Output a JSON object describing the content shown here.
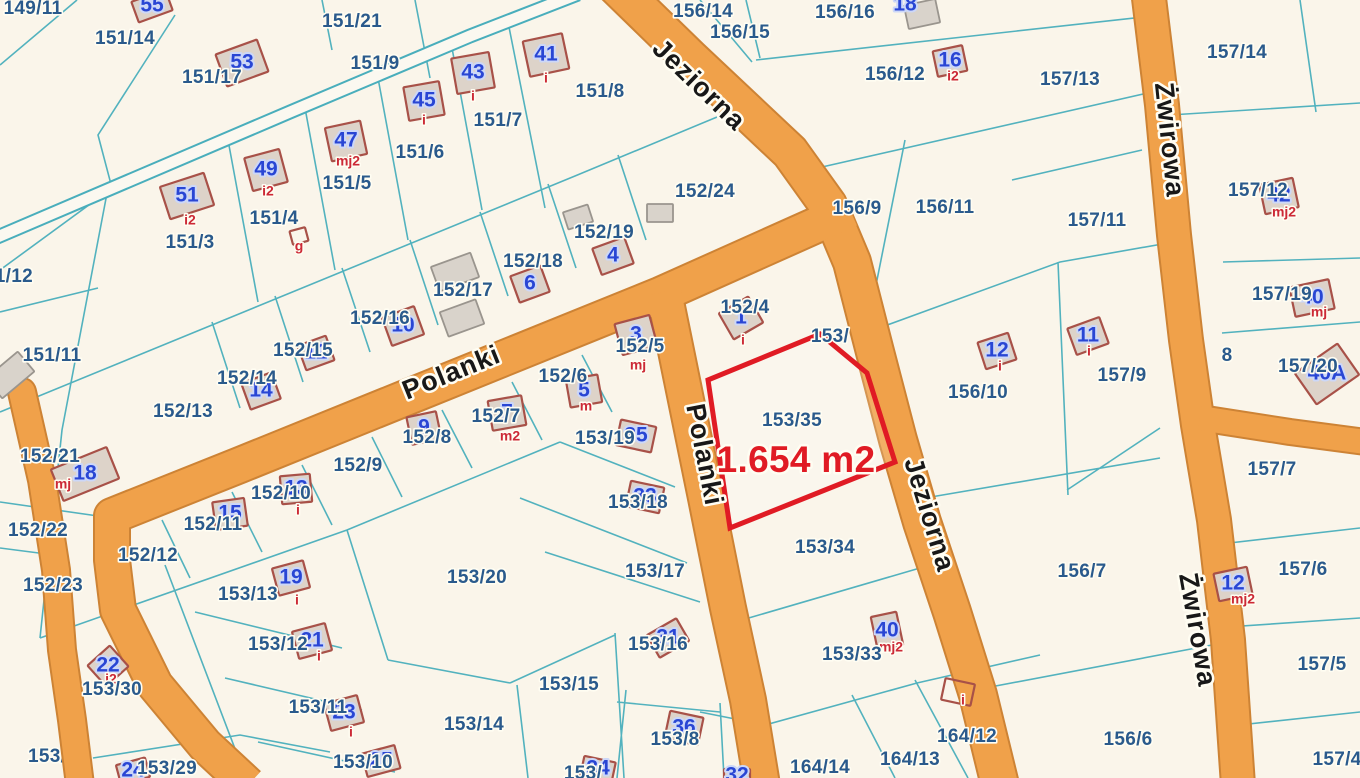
{
  "map": {
    "highlight": {
      "parcel": "153/35",
      "area_label": "1.654 m2"
    },
    "colors": {
      "background": "#faf5ea",
      "road": "#f0a14a",
      "road_casing": "#cd8335",
      "boundary": "#49aebc",
      "parcel_text": "#2a5a8c",
      "building_number": "#2946d4",
      "building_fill": "#ddd3c9",
      "building_outline": "#a85148",
      "sub_label": "#cc2936",
      "highlight_red": "#e01b24",
      "path_fill": "#fbf8f0"
    },
    "streets": [
      {
        "name": "Jeziorna",
        "x": 698,
        "y": 86,
        "rot": 44
      },
      {
        "name": "Jeziorna",
        "x": 928,
        "y": 515,
        "rot": 73
      },
      {
        "name": "Polanki",
        "x": 452,
        "y": 374,
        "rot": -22
      },
      {
        "name": "Polanki",
        "x": 703,
        "y": 455,
        "rot": 79
      },
      {
        "name": "Żwirowa",
        "x": 1168,
        "y": 140,
        "rot": 84
      },
      {
        "name": "Żwirowa",
        "x": 1196,
        "y": 630,
        "rot": 80
      }
    ],
    "parcels": [
      {
        "t": "149/11",
        "x": 33,
        "y": 9
      },
      {
        "t": "151/14",
        "x": 125,
        "y": 39
      },
      {
        "t": "151/17",
        "x": 212,
        "y": 78
      },
      {
        "t": "151/21",
        "x": 352,
        "y": 22
      },
      {
        "t": "151/9",
        "x": 375,
        "y": 64
      },
      {
        "t": "151/8",
        "x": 600,
        "y": 92
      },
      {
        "t": "151/7",
        "x": 498,
        "y": 121
      },
      {
        "t": "151/6",
        "x": 420,
        "y": 153
      },
      {
        "t": "151/5",
        "x": 347,
        "y": 184
      },
      {
        "t": "151/4",
        "x": 274,
        "y": 219
      },
      {
        "t": "151/3",
        "x": 190,
        "y": 243
      },
      {
        "t": "151/12",
        "x": 3,
        "y": 277
      },
      {
        "t": "151/11",
        "x": 52,
        "y": 356
      },
      {
        "t": "152/13",
        "x": 183,
        "y": 412
      },
      {
        "t": "152/14",
        "x": 247,
        "y": 379
      },
      {
        "t": "152/15",
        "x": 303,
        "y": 351
      },
      {
        "t": "152/16",
        "x": 380,
        "y": 319
      },
      {
        "t": "152/17",
        "x": 463,
        "y": 291
      },
      {
        "t": "152/18",
        "x": 533,
        "y": 262
      },
      {
        "t": "152/19",
        "x": 604,
        "y": 233
      },
      {
        "t": "152/24",
        "x": 705,
        "y": 192
      },
      {
        "t": "152/21",
        "x": 50,
        "y": 457
      },
      {
        "t": "152/22",
        "x": 38,
        "y": 531
      },
      {
        "t": "152/23",
        "x": 53,
        "y": 586
      },
      {
        "t": "152/12",
        "x": 148,
        "y": 556
      },
      {
        "t": "152/11",
        "x": 213,
        "y": 525
      },
      {
        "t": "152/10",
        "x": 281,
        "y": 494
      },
      {
        "t": "152/9",
        "x": 358,
        "y": 466
      },
      {
        "t": "152/8",
        "x": 427,
        "y": 438
      },
      {
        "t": "152/7",
        "x": 496,
        "y": 417
      },
      {
        "t": "152/6",
        "x": 563,
        "y": 377
      },
      {
        "t": "152/5",
        "x": 640,
        "y": 347
      },
      {
        "t": "152/4",
        "x": 745,
        "y": 308
      },
      {
        "t": "153/",
        "x": 830,
        "y": 337
      },
      {
        "t": "153/35",
        "x": 792,
        "y": 421
      },
      {
        "t": "1.654 m2",
        "x": 796,
        "y": 462,
        "cls": "area"
      },
      {
        "t": "153/34",
        "x": 825,
        "y": 548
      },
      {
        "t": "153/33",
        "x": 852,
        "y": 655
      },
      {
        "t": "153/19",
        "x": 605,
        "y": 439
      },
      {
        "t": "153/18",
        "x": 638,
        "y": 503
      },
      {
        "t": "153/17",
        "x": 655,
        "y": 572
      },
      {
        "t": "153/16",
        "x": 658,
        "y": 645
      },
      {
        "t": "153/20",
        "x": 477,
        "y": 578
      },
      {
        "t": "153/15",
        "x": 569,
        "y": 685
      },
      {
        "t": "153/14",
        "x": 474,
        "y": 725
      },
      {
        "t": "153/13",
        "x": 248,
        "y": 595
      },
      {
        "t": "153/12",
        "x": 278,
        "y": 645
      },
      {
        "t": "153/11",
        "x": 318,
        "y": 708
      },
      {
        "t": "153/10",
        "x": 363,
        "y": 763
      },
      {
        "t": "153/30",
        "x": 112,
        "y": 690
      },
      {
        "t": "153/29",
        "x": 167,
        "y": 769
      },
      {
        "t": "153/31",
        "x": 58,
        "y": 757,
        "under": true
      },
      {
        "t": "153/8",
        "x": 675,
        "y": 740
      },
      {
        "t": "153/",
        "x": 583,
        "y": 774
      },
      {
        "t": "164/14",
        "x": 820,
        "y": 768
      },
      {
        "t": "164/13",
        "x": 910,
        "y": 760
      },
      {
        "t": "164/12",
        "x": 967,
        "y": 737
      },
      {
        "t": "156/14",
        "x": 703,
        "y": 12
      },
      {
        "t": "156/15",
        "x": 740,
        "y": 33
      },
      {
        "t": "156/16",
        "x": 845,
        "y": 13
      },
      {
        "t": "156/12",
        "x": 895,
        "y": 75
      },
      {
        "t": "156/9",
        "x": 857,
        "y": 209
      },
      {
        "t": "156/11",
        "x": 945,
        "y": 208
      },
      {
        "t": "156/10",
        "x": 978,
        "y": 393
      },
      {
        "t": "156/7",
        "x": 1082,
        "y": 572
      },
      {
        "t": "156/6",
        "x": 1128,
        "y": 740
      },
      {
        "t": "157/13",
        "x": 1070,
        "y": 80
      },
      {
        "t": "157/14",
        "x": 1237,
        "y": 53
      },
      {
        "t": "157/11",
        "x": 1097,
        "y": 221
      },
      {
        "t": "157/12",
        "x": 1258,
        "y": 191
      },
      {
        "t": "157/9",
        "x": 1122,
        "y": 376
      },
      {
        "t": "157/19",
        "x": 1282,
        "y": 295
      },
      {
        "t": "157/20",
        "x": 1308,
        "y": 367
      },
      {
        "t": "8",
        "x": 1227,
        "y": 356
      },
      {
        "t": "157/7",
        "x": 1272,
        "y": 470
      },
      {
        "t": "157/6",
        "x": 1303,
        "y": 570
      },
      {
        "t": "157/5",
        "x": 1322,
        "y": 665
      },
      {
        "t": "157/4",
        "x": 1337,
        "y": 760
      }
    ],
    "buildings": [
      {
        "n": "55",
        "x": 152,
        "y": 6,
        "r": -20,
        "w": 36,
        "h": 22
      },
      {
        "n": "53",
        "x": 242,
        "y": 63,
        "r": -20,
        "w": 44,
        "h": 34
      },
      {
        "n": "41",
        "x": 546,
        "y": 55,
        "r": -12,
        "w": 40,
        "h": 36,
        "sub": "i",
        "sx": 546,
        "sy": 79
      },
      {
        "n": "43",
        "x": 473,
        "y": 73,
        "r": -10,
        "w": 38,
        "h": 36,
        "sub": "i",
        "sx": 473,
        "sy": 97
      },
      {
        "n": "45",
        "x": 424,
        "y": 101,
        "r": -10,
        "w": 36,
        "h": 34,
        "sub": "i",
        "sx": 424,
        "sy": 121
      },
      {
        "n": "47",
        "x": 346,
        "y": 141,
        "r": -12,
        "w": 36,
        "h": 34,
        "sub": "mj2",
        "sx": 348,
        "sy": 162
      },
      {
        "n": "49",
        "x": 266,
        "y": 170,
        "r": -15,
        "w": 36,
        "h": 34,
        "sub": "i2",
        "sx": 268,
        "sy": 192
      },
      {
        "n": "51",
        "x": 187,
        "y": 196,
        "r": -18,
        "w": 46,
        "h": 34,
        "sub": "i2",
        "sx": 190,
        "sy": 221
      },
      {
        "n": "",
        "x": 299,
        "y": 236,
        "r": -15,
        "w": 16,
        "h": 14,
        "hollow": true,
        "sub": "g",
        "sx": 299,
        "sy": 247
      },
      {
        "n": "4",
        "x": 613,
        "y": 256,
        "r": -20,
        "w": 34,
        "h": 28
      },
      {
        "n": "6",
        "x": 530,
        "y": 284,
        "r": -20,
        "w": 32,
        "h": 28
      },
      {
        "n": "10",
        "x": 403,
        "y": 326,
        "r": -20,
        "w": 34,
        "h": 30
      },
      {
        "n": "12",
        "x": 316,
        "y": 353,
        "r": -20,
        "w": 30,
        "h": 26
      },
      {
        "n": "14",
        "x": 261,
        "y": 391,
        "r": -20,
        "w": 32,
        "h": 28
      },
      {
        "n": "18",
        "x": 85,
        "y": 474,
        "r": -22,
        "w": 60,
        "h": 34,
        "sub": "mj",
        "sx": 63,
        "sy": 485
      },
      {
        "n": "15",
        "x": 230,
        "y": 514,
        "r": -8,
        "w": 32,
        "h": 28
      },
      {
        "n": "13",
        "x": 296,
        "y": 489,
        "r": -5,
        "w": 30,
        "h": 28,
        "sub": "i",
        "sx": 298,
        "sy": 511
      },
      {
        "n": "9",
        "x": 424,
        "y": 428,
        "r": -12,
        "w": 30,
        "h": 28
      },
      {
        "n": "7",
        "x": 507,
        "y": 413,
        "r": -10,
        "w": 34,
        "h": 30,
        "sub": "m2",
        "sx": 510,
        "sy": 437
      },
      {
        "n": "5",
        "x": 584,
        "y": 391,
        "r": -10,
        "w": 32,
        "h": 28,
        "sub": "m",
        "sx": 586,
        "sy": 407
      },
      {
        "n": "3",
        "x": 636,
        "y": 335,
        "r": -15,
        "w": 36,
        "h": 32,
        "sub": "mj",
        "sx": 638,
        "sy": 366
      },
      {
        "n": "1",
        "x": 741,
        "y": 318,
        "r": -30,
        "w": 34,
        "h": 30,
        "sub": "i",
        "sx": 743,
        "sy": 341
      },
      {
        "n": "35",
        "x": 636,
        "y": 436,
        "r": 12,
        "w": 36,
        "h": 26
      },
      {
        "n": "33",
        "x": 645,
        "y": 497,
        "r": 12,
        "w": 34,
        "h": 26
      },
      {
        "n": "31",
        "x": 668,
        "y": 638,
        "r": -30,
        "w": 34,
        "h": 26
      },
      {
        "n": "19",
        "x": 291,
        "y": 578,
        "r": -15,
        "w": 32,
        "h": 28,
        "sub": "i",
        "sx": 297,
        "sy": 601
      },
      {
        "n": "21",
        "x": 312,
        "y": 641,
        "r": -15,
        "w": 34,
        "h": 28,
        "sub": "i",
        "sx": 319,
        "sy": 657
      },
      {
        "n": "23",
        "x": 344,
        "y": 713,
        "r": -15,
        "w": 34,
        "h": 28,
        "sub": "i",
        "sx": 351,
        "sy": 733
      },
      {
        "n": "25",
        "x": 381,
        "y": 761,
        "r": -15,
        "w": 34,
        "h": 24
      },
      {
        "n": "24",
        "x": 133,
        "y": 771,
        "r": -15,
        "w": 30,
        "h": 20
      },
      {
        "n": "22",
        "x": 108,
        "y": 666,
        "r": -42,
        "w": 30,
        "h": 28,
        "sub": "i2",
        "sx": 111,
        "sy": 680
      },
      {
        "n": "34",
        "x": 598,
        "y": 769,
        "r": 12,
        "w": 32,
        "h": 20
      },
      {
        "n": "36",
        "x": 684,
        "y": 728,
        "r": 12,
        "w": 34,
        "h": 28
      },
      {
        "n": "32",
        "x": 737,
        "y": 776,
        "r": 0,
        "w": 26,
        "h": 14
      },
      {
        "n": "40",
        "x": 887,
        "y": 631,
        "r": 78,
        "w": 34,
        "h": 26,
        "sub": "mj2",
        "sx": 891,
        "sy": 648
      },
      {
        "n": "",
        "x": 958,
        "y": 692,
        "r": 12,
        "w": 30,
        "h": 22,
        "hollow": true,
        "sub": "i",
        "sx": 963,
        "sy": 701
      },
      {
        "n": "12",
        "x": 997,
        "y": 351,
        "r": -18,
        "w": 32,
        "h": 28,
        "sub": "i",
        "sx": 1000,
        "sy": 367
      },
      {
        "n": "16",
        "x": 950,
        "y": 61,
        "r": -12,
        "w": 30,
        "h": 26,
        "sub": "i2",
        "sx": 953,
        "sy": 77
      },
      {
        "n": "18",
        "x": 922,
        "y": 14,
        "r": -12,
        "w": 32,
        "h": 24,
        "grey": true,
        "nx": 905,
        "ny": 5
      },
      {
        "n": "11",
        "x": 1088,
        "y": 336,
        "r": -20,
        "w": 34,
        "h": 28,
        "sub": "i",
        "sx": 1089,
        "sy": 352
      },
      {
        "n": "42",
        "x": 1279,
        "y": 196,
        "r": -12,
        "w": 34,
        "h": 30,
        "sub": "mj2",
        "sx": 1284,
        "sy": 213
      },
      {
        "n": "40",
        "x": 1312,
        "y": 298,
        "r": -12,
        "w": 40,
        "h": 30,
        "sub": "mj",
        "sx": 1319,
        "sy": 313
      },
      {
        "n": "40A",
        "x": 1327,
        "y": 374,
        "r": -35,
        "w": 52,
        "h": 38
      },
      {
        "n": "12",
        "x": 1233,
        "y": 584,
        "r": -12,
        "w": 34,
        "h": 28,
        "sub": "mj2",
        "sx": 1243,
        "sy": 600
      },
      {
        "n": "",
        "x": 10,
        "y": 375,
        "r": -40,
        "w": 42,
        "h": 26,
        "grey": true
      },
      {
        "n": "",
        "x": 455,
        "y": 272,
        "r": -20,
        "w": 42,
        "h": 26,
        "grey": true
      },
      {
        "n": "",
        "x": 462,
        "y": 318,
        "r": -20,
        "w": 38,
        "h": 26,
        "grey": true
      },
      {
        "n": "",
        "x": 578,
        "y": 217,
        "r": -18,
        "w": 26,
        "h": 18,
        "grey": true
      },
      {
        "n": "",
        "x": 660,
        "y": 213,
        "r": 0,
        "w": 26,
        "h": 18,
        "grey": true
      }
    ]
  }
}
